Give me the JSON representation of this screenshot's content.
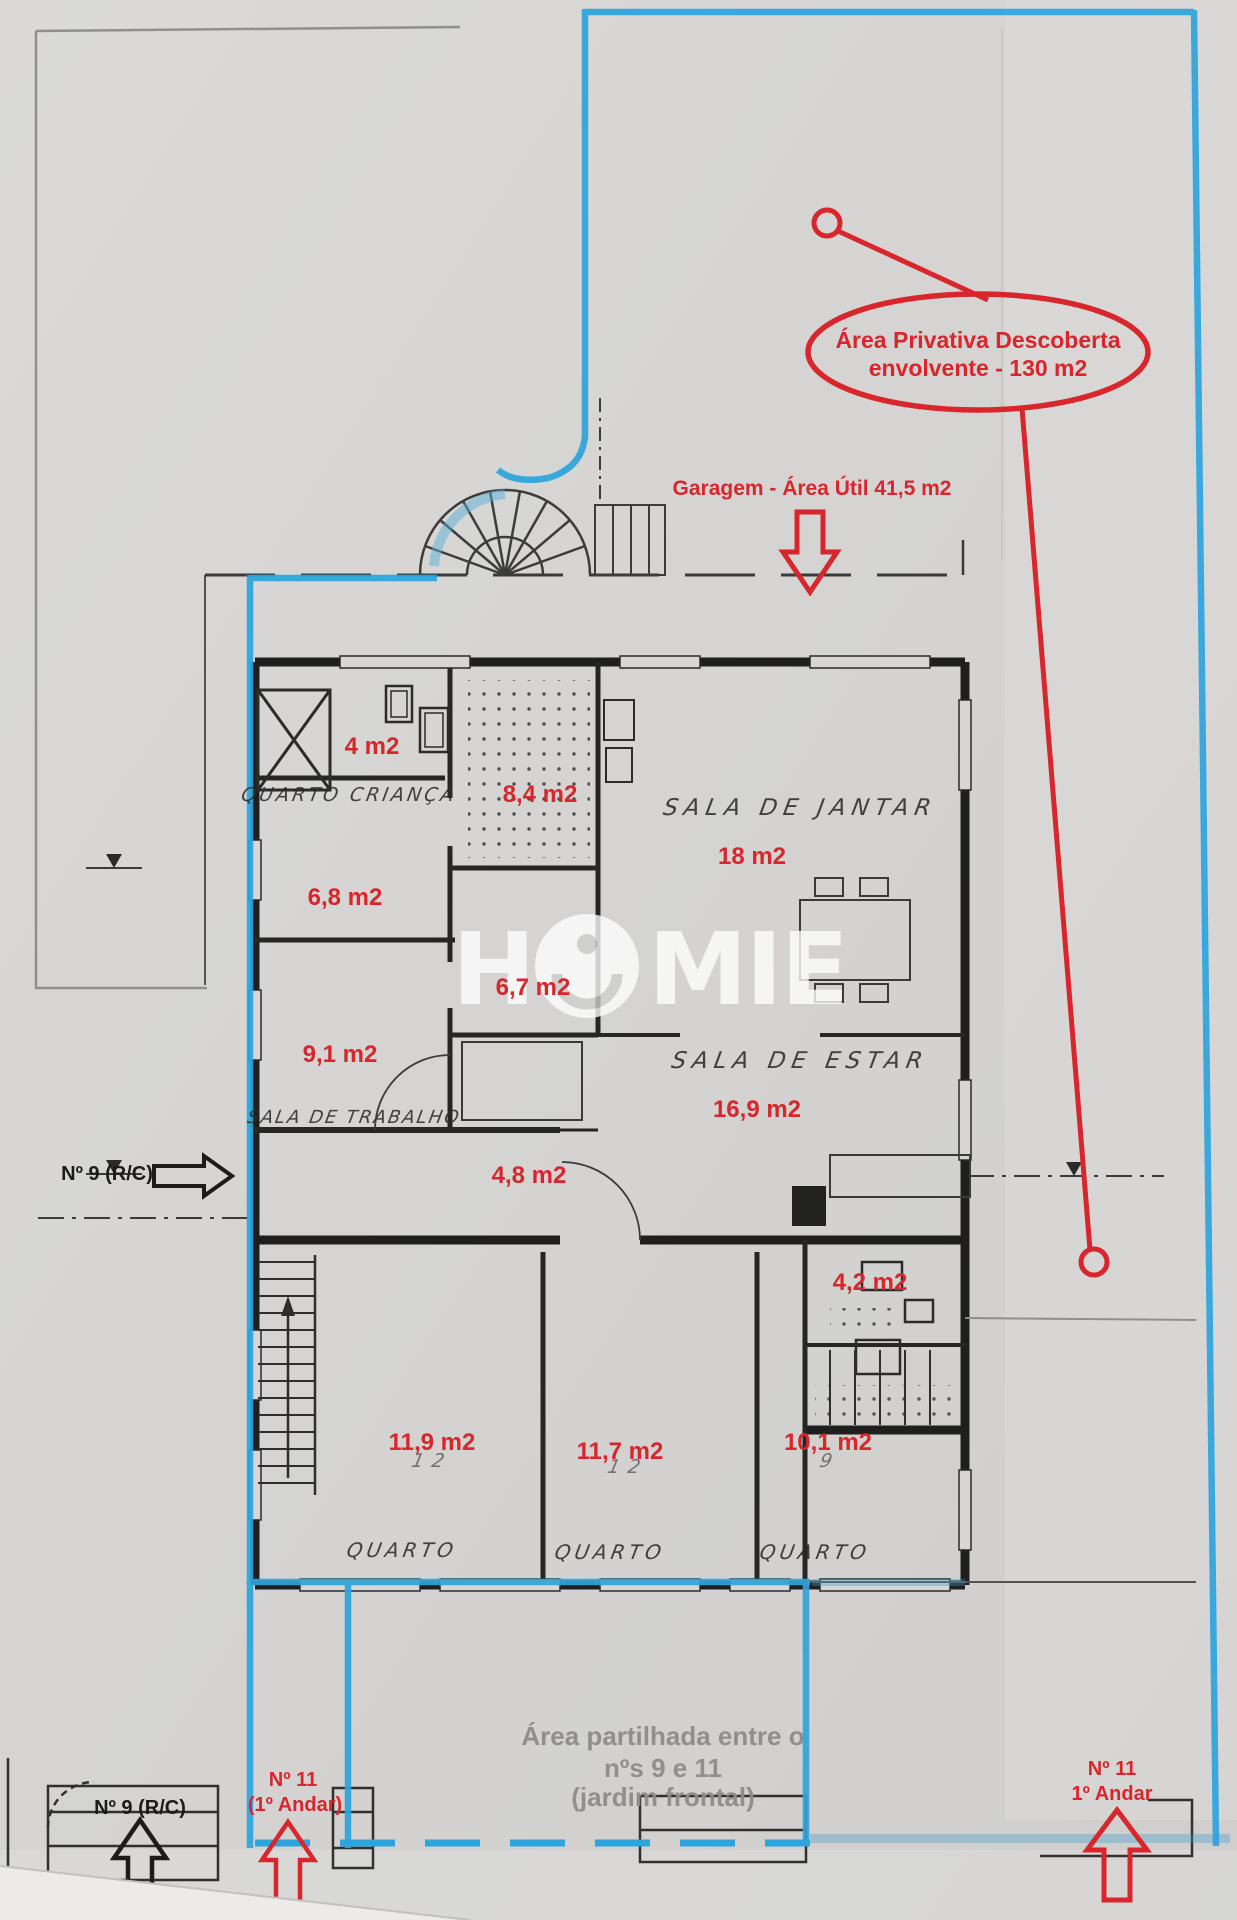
{
  "callout": {
    "line1": "Área Privativa Descoberta",
    "line2": "envolvente - 130 m2"
  },
  "garage": {
    "label": "Garagem - Área Útil 41,5 m2"
  },
  "markers": {
    "left_side": "Nº 9 (R/C)",
    "bottom_left_black": "Nº 9 (R/C)",
    "bottom_left_red_line1": "Nº 11",
    "bottom_left_red_line2": "(1º Andar)",
    "bottom_right_red_line1": "Nº 11",
    "bottom_right_red_line2": "1º Andar"
  },
  "shared_area": {
    "line1": "Área partilhada entre o",
    "line2": "nºs 9 e 11",
    "line3": "(jardim frontal)"
  },
  "rooms": [
    {
      "label": "4 m2"
    },
    {
      "label": "8,4 m2"
    },
    {
      "label": "18 m2"
    },
    {
      "label": "6,8 m2"
    },
    {
      "label": "6,7 m2"
    },
    {
      "label": "9,1 m2"
    },
    {
      "label": "16,9 m2"
    },
    {
      "label": "4,8 m2"
    },
    {
      "label": "4,2 m2"
    },
    {
      "label": "11,9 m2"
    },
    {
      "label": "11,7 m2"
    },
    {
      "label": "10,1 m2"
    }
  ],
  "handwritten": [
    {
      "label": "QUARTO CRIANÇA"
    },
    {
      "label": "SALA DE JANTAR"
    },
    {
      "label": "SALA DE ESTAR"
    },
    {
      "label": "SALA DE TRABALHO"
    },
    {
      "label": "QUARTO"
    },
    {
      "label": "QUARTO"
    },
    {
      "label": "QUARTO"
    }
  ],
  "pencil": [
    {
      "label": "12"
    },
    {
      "label": "12"
    },
    {
      "label": "9"
    }
  ],
  "watermark": {
    "full": "HOMIE",
    "h": "H",
    "mie": "MIE"
  },
  "colors": {
    "annotation_red": "#d8262c",
    "outline_blue": "#2da4dc",
    "ink_black": "#22221f",
    "paper": "#d7d6d4",
    "gray_text": "#8d8c8a"
  }
}
